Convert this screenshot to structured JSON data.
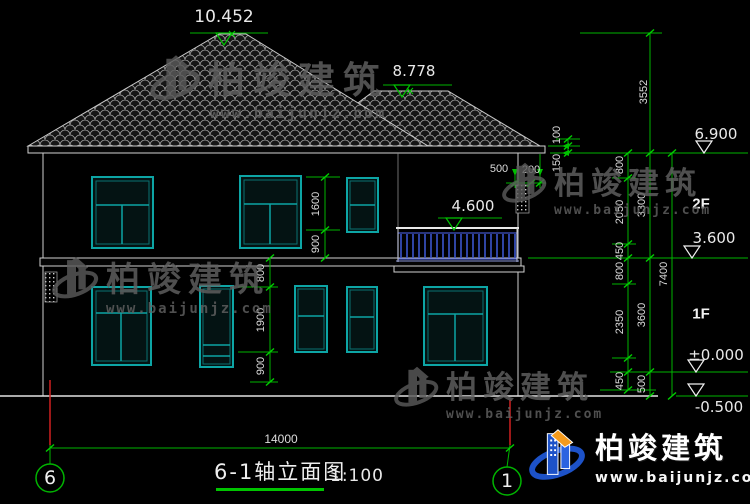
{
  "drawing": {
    "title": "6-1轴立面图",
    "scale": "1:100",
    "axis_left": "6",
    "axis_right": "1",
    "floor_labels": {
      "f2": "2F",
      "f1": "1F"
    },
    "elevations": {
      "roof_main": "10.452",
      "roof_wing": "8.778",
      "eave": "6.900",
      "balcony_rail": "4.600",
      "floor2": "3.600",
      "ground_floor": "±0.000",
      "site": "-0.500"
    },
    "dims": {
      "total_width": "14000",
      "total_height": "7400",
      "roof_height": "3552",
      "right_inner": [
        "800",
        "2050",
        "450",
        "800",
        "2350",
        "450"
      ],
      "right_mid": [
        "3300",
        "3600",
        "500"
      ],
      "eave_detail": [
        "100",
        "150"
      ],
      "eave_overhang": [
        "500",
        "200"
      ],
      "win2f": [
        "1600",
        "900"
      ],
      "win1f": [
        "800",
        "1900",
        "900"
      ]
    }
  },
  "watermark": {
    "brand": "柏竣建筑",
    "site": "www.baijunjz.com"
  },
  "logo": {
    "brand": "柏竣建筑",
    "site": "www.baijunjz.com"
  }
}
